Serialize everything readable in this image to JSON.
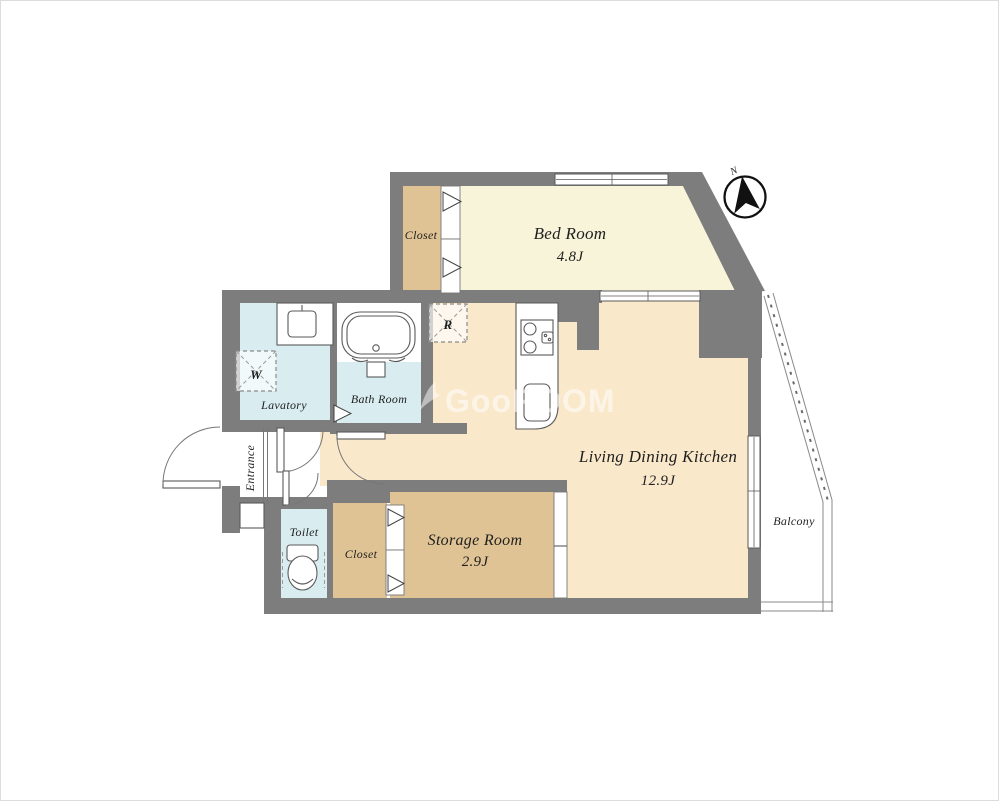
{
  "colors": {
    "wall": "#7d7d7d",
    "bedroom_floor": "#f8f4d9",
    "closet_floor": "#e0c394",
    "ldk_floor": "#fae8cb",
    "wet_floor": "#d9edf1",
    "outline": "#555555",
    "label": "#1f1f1f",
    "watermark": "#ffffff"
  },
  "rooms": {
    "bedroom": {
      "name": "Bed Room",
      "area": "4.8J"
    },
    "bedroom_closet": {
      "name": "Closet"
    },
    "ldk": {
      "name": "Living Dining Kitchen",
      "area": "12.9J"
    },
    "storage": {
      "name": "Storage Room",
      "area": "2.9J"
    },
    "lower_closet": {
      "name": "Closet"
    },
    "toilet": {
      "name": "Toilet"
    },
    "bath": {
      "name": "Bath Room"
    },
    "lavatory": {
      "name": "Lavatory"
    },
    "entrance": {
      "name": "Entrance"
    },
    "balcony": {
      "name": "Balcony"
    }
  },
  "markers": {
    "washer": "W",
    "fridge": "R",
    "north": "N"
  },
  "watermark": {
    "text": "GooROOM"
  }
}
